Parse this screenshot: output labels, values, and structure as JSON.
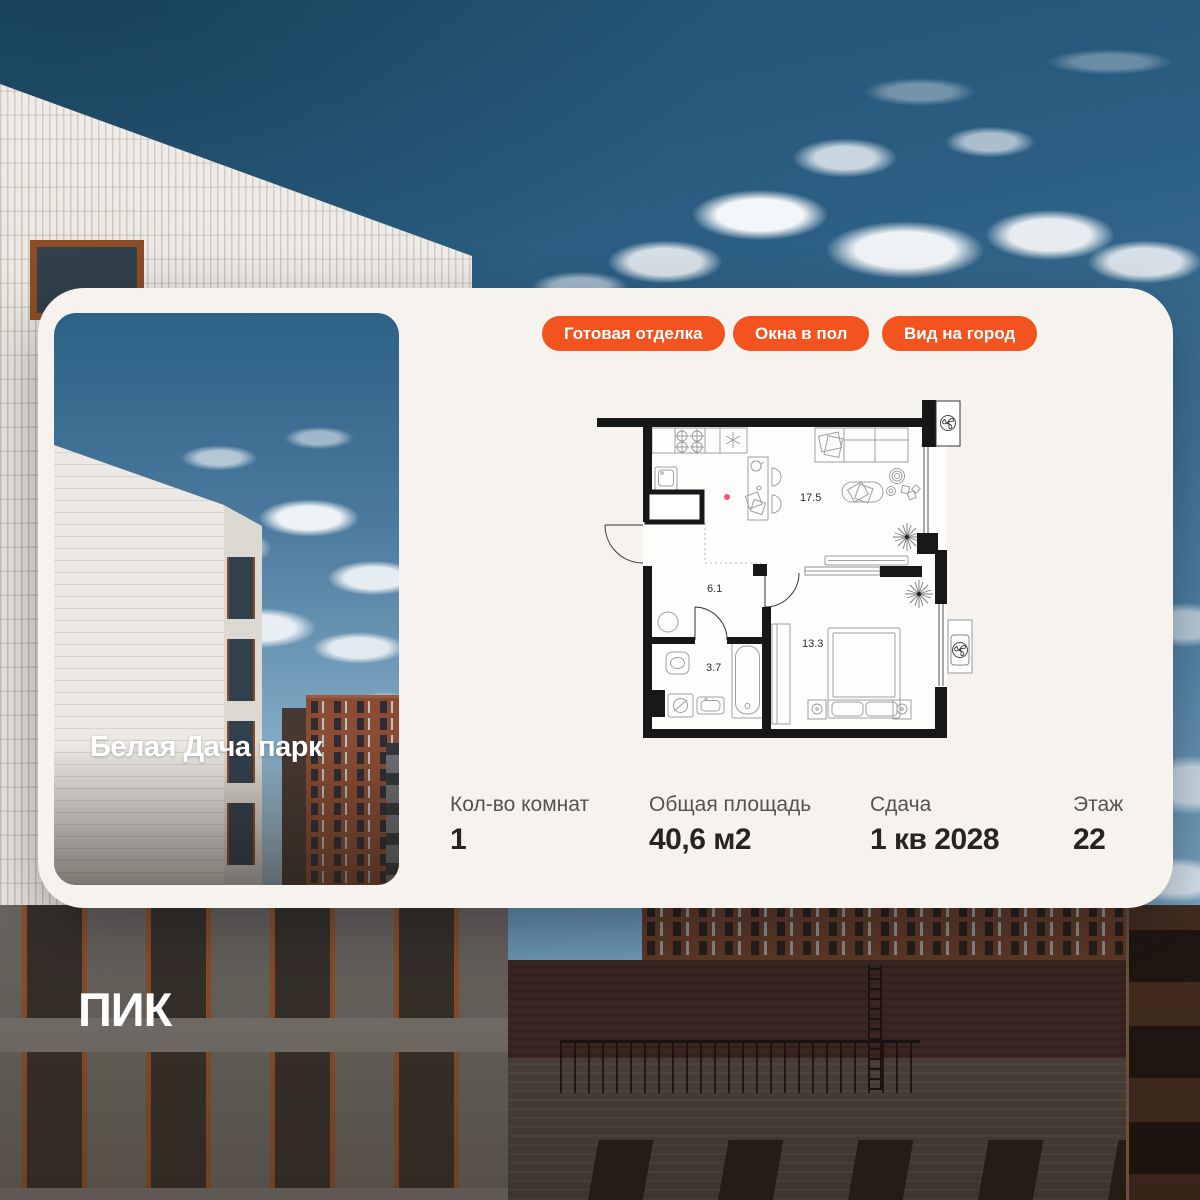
{
  "card": {
    "badges": [
      "Готовая отделка",
      "Окна в пол",
      "Вид на город"
    ],
    "photo": {
      "project_name": "Белая Дача парк"
    },
    "floor_plan": {
      "room_areas": {
        "kitchen_living": "17.5",
        "hallway": "6.1",
        "bathroom": "3.7",
        "bedroom": "13.3"
      }
    },
    "stats": [
      {
        "label": "Кол-во комнат",
        "value": "1"
      },
      {
        "label": "Общая площадь",
        "value": "40,6 м2"
      },
      {
        "label": "Сдача",
        "value": "1 кв 2028"
      },
      {
        "label": "Этаж",
        "value": "22"
      }
    ]
  },
  "brand": {
    "logo_text": "ПИК"
  },
  "colors": {
    "accent_orange": "#f3541f",
    "card_background": "#f6f3ef",
    "badge_text": "#ffffff",
    "plan_walls": "#171717"
  }
}
